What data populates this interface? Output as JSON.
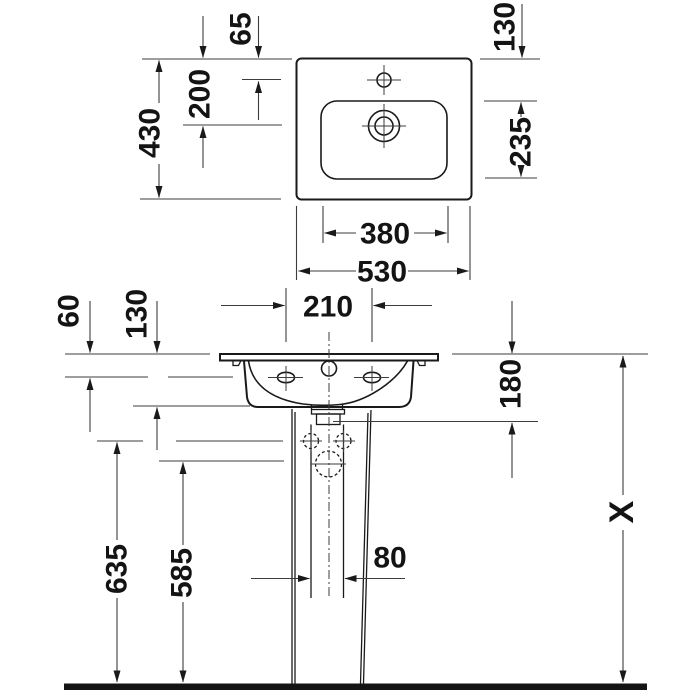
{
  "drawing": {
    "type": "washbasin-with-pedestal-dimension-drawing",
    "colors": {
      "line": "#1a1a1a",
      "dim_line": "#3c3c3c",
      "background": "#ffffff"
    },
    "top_view": {
      "dim_depth_total": "430",
      "dim_faucet_hole_offset": "65",
      "dim_drain_offset": "200",
      "dim_rim_to_bowl": "130",
      "dim_bowl_depth": "235",
      "dim_bowl_width": "380",
      "dim_width_total": "530"
    },
    "front_view": {
      "dim_rim_drop": "60",
      "dim_apron_height": "130",
      "dim_hole_spacing": "210",
      "dim_basin_body_height": "180",
      "dim_fixing_hole_height": "635",
      "dim_siphon_height": "585",
      "dim_drain_clearance": "80",
      "dim_installation_height": "X"
    }
  }
}
